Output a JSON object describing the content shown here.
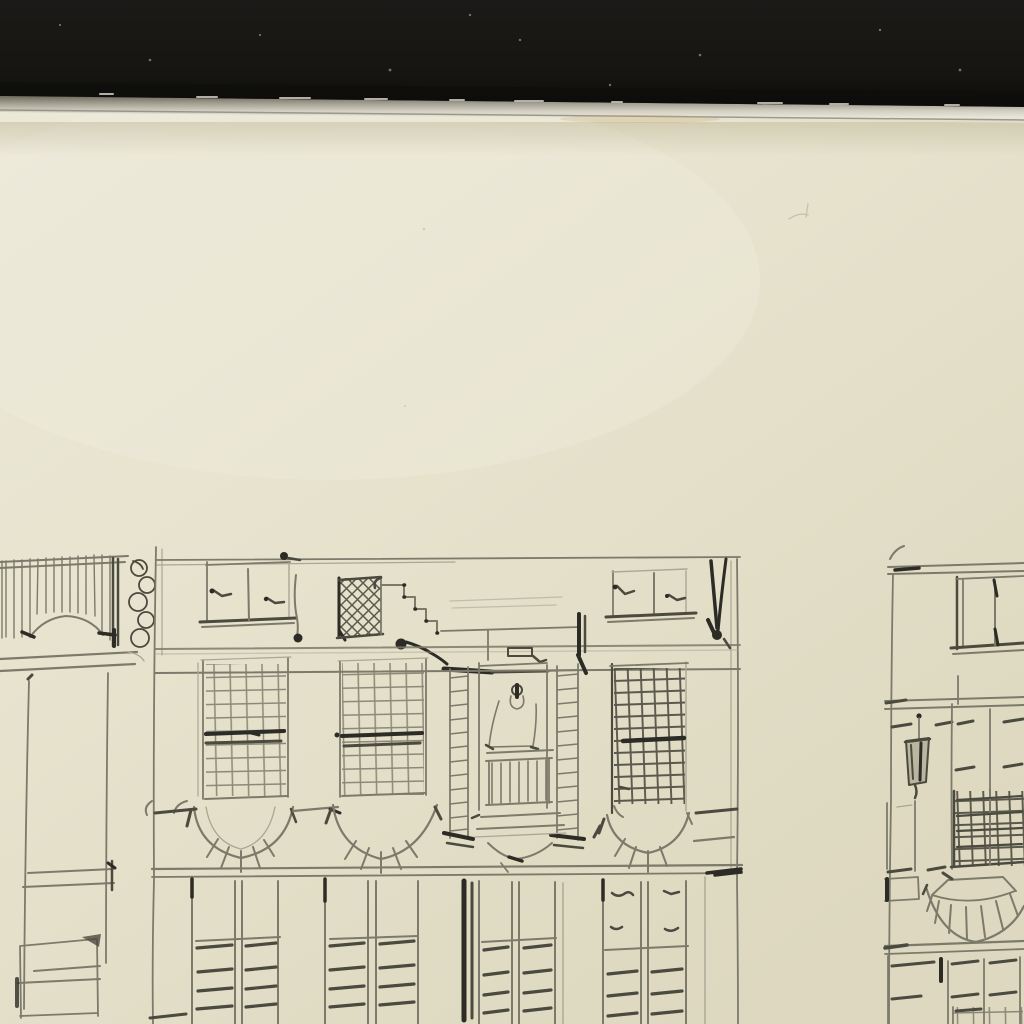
{
  "scene": {
    "type": "sketchbook-page-photo",
    "description": "Graphite pencil sketch of canal-house facades drawn across the lower half of a cream sketchbook page; the black book cover shows as a dark band along the top edge with the pale page edge below it",
    "colors": {
      "cover_black": "#161511",
      "cover_black_deep": "#0c0b09",
      "chip_light": "#cfccbf",
      "edge_dark": "#6e6b5e",
      "edge_mid": "#a7a496",
      "edge_light": "#e9e6da",
      "paper_light": "#ece9da",
      "paper_base": "#e7e3ce",
      "paper_dark": "#ddd8bf",
      "pencil_light": "#a9a795",
      "pencil_mid": "#7c7a6b",
      "pencil_dark": "#4b4a3f",
      "pencil_black": "#2c2b25"
    },
    "regions": {
      "cover_band": {
        "label": "black sketchbook cover band"
      },
      "page_edge": {
        "label": "pale page edge under the cover"
      },
      "paper": {
        "label": "cream sketchbook paper"
      },
      "left_facade": {
        "label": "partial facade sketch cropped at left: hatched balcony, scroll scribbles, tall doorway, panelled door"
      },
      "center_facade": {
        "label": "main facade sketch: attic windows with lattice pane and stepped gable, three gridded sash windows, central doorway with ladder pilasters and balcony, arched aprons, shuttered ground floor"
      },
      "right_facade": {
        "label": "partial facade sketch cropped at right: cornice, sash window, hanging lantern, gridded window over fan-arched opening, shuttered panels"
      }
    }
  }
}
